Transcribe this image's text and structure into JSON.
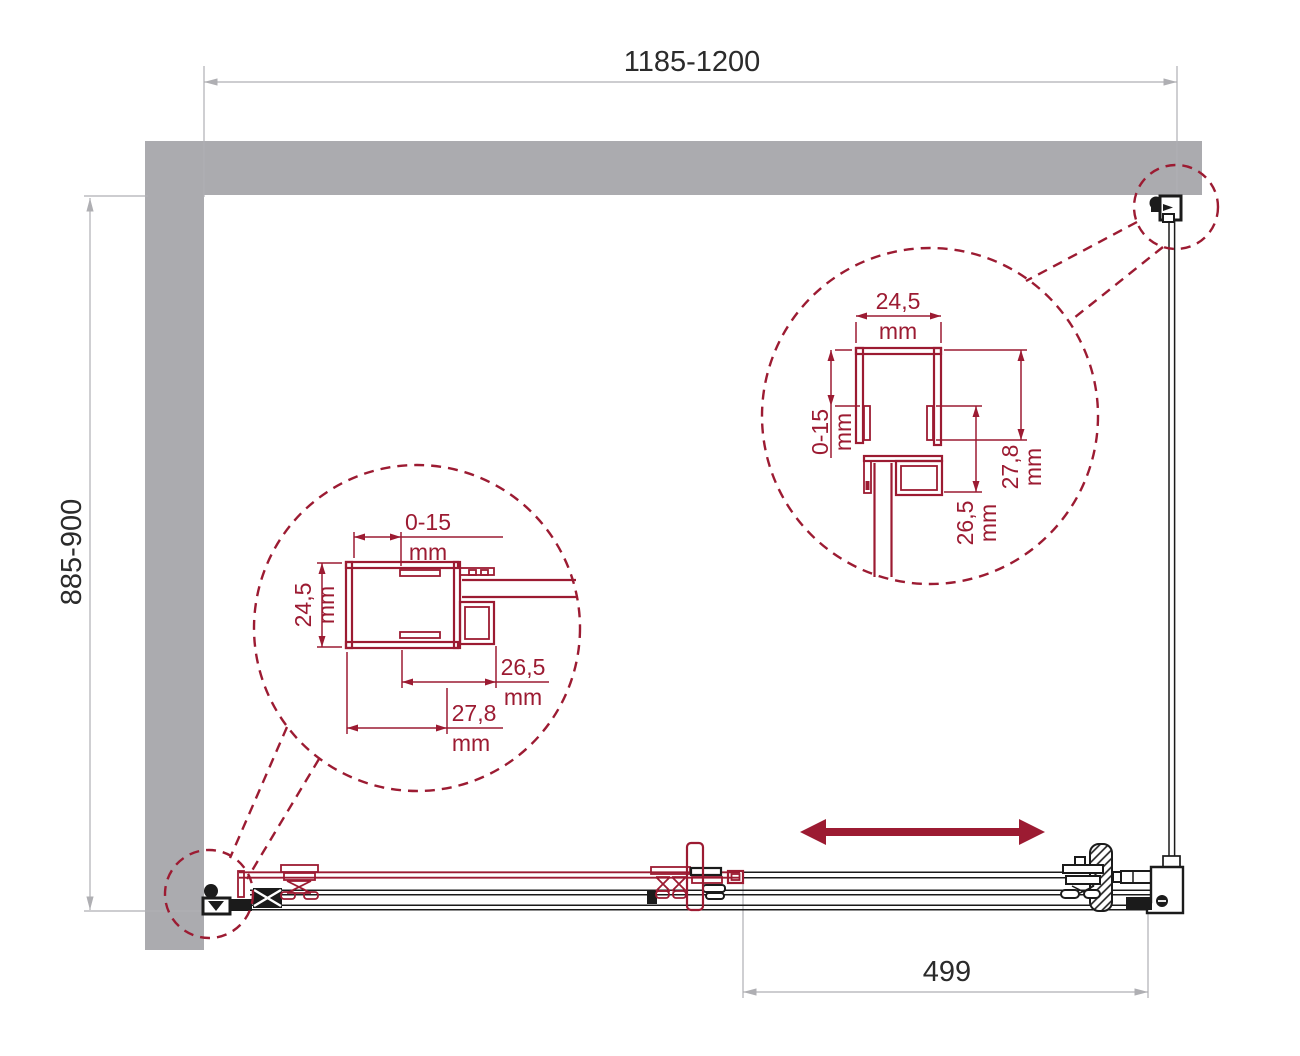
{
  "colors": {
    "accent": "#9C1B32",
    "wall_gray": "#ABABAF",
    "dim_gray": "#AFAFB3",
    "ink": "#1B1B1B",
    "dim_text": "#2B2B2B",
    "background": "#FFFFFF"
  },
  "icons": {
    "slide_direction": "left-right-double-arrow"
  },
  "main_dimensions": {
    "top_width": "1185-1200",
    "left_depth": "885-900",
    "bottom_door": "499"
  },
  "detail_top_right": {
    "profile_width": "24,5",
    "profile_width_unit": "mm",
    "adjustment_range": "0-15",
    "adjustment_range_unit": "mm",
    "depth_inner": "26,5",
    "depth_inner_unit": "mm",
    "depth_outer": "27,8",
    "depth_outer_unit": "mm"
  },
  "detail_center_left": {
    "adjustment_range": "0-15",
    "adjustment_range_unit": "mm",
    "profile_width": "24,5",
    "profile_width_unit": "mm",
    "depth_inner": "26,5",
    "depth_inner_unit": "mm",
    "depth_outer": "27,8",
    "depth_outer_unit": "mm"
  }
}
